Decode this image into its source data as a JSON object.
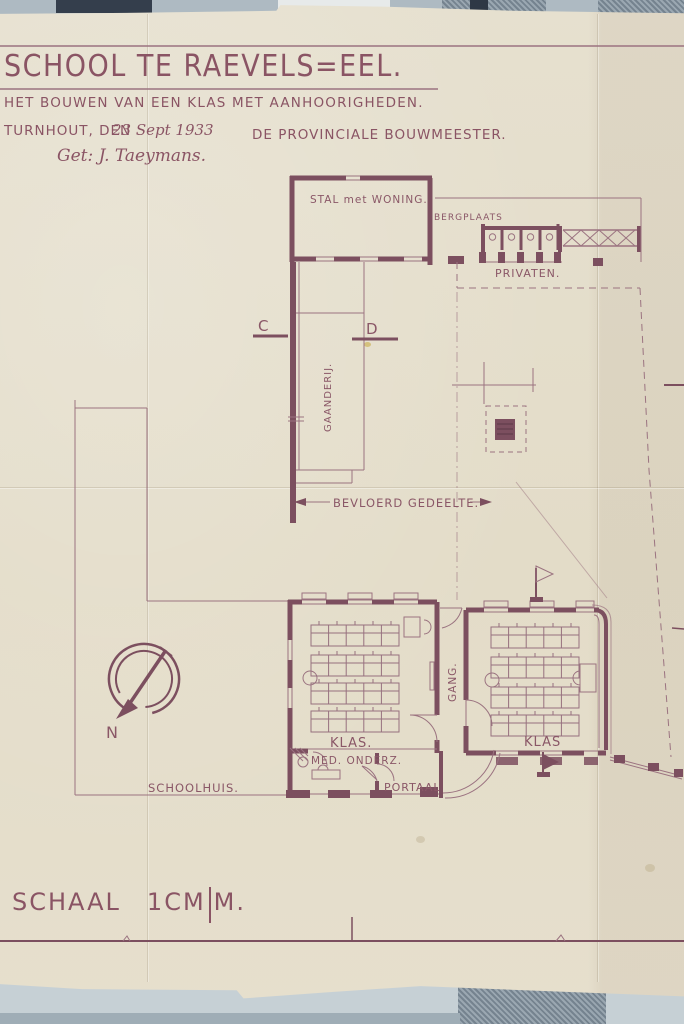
{
  "document": {
    "title": "SCHOOL TE RAEVELS=EEL.",
    "subtitle": "HET BOUWEN VAN EEN KLAS MET AANHOORIGHEDEN.",
    "place_label": "TURNHOUT, DEN",
    "date": "23 Sept 1933",
    "authority": "DE PROVINCIALE BOUWMEESTER.",
    "signature": "Get: J. Taeymans."
  },
  "plan": {
    "labels": {
      "stal": "STAL met WONING.",
      "bergplaats": "BERGPLAATS",
      "privaten": "PRIVATEN.",
      "gaanderij": "GAANDERIJ.",
      "bevloerd_gedeelte": "BEVLOERD GEDEELTE.",
      "gang": "GANG.",
      "klas_left": "KLAS.",
      "klas_right": "KLAS",
      "med_onderz": "MED. ONDERZ.",
      "portaal": "PORTAAL",
      "schoolhuis": "SCHOOLHUIS.",
      "section_c": "C",
      "section_d": "D",
      "north": "N"
    }
  },
  "footer": {
    "scale_label": "SCHAAL",
    "scale_value": "1CM",
    "scale_unit": "M."
  },
  "colors": {
    "ink": "#8a5767",
    "paper": "#e3dcc8",
    "backing": "#b7c2c9"
  }
}
